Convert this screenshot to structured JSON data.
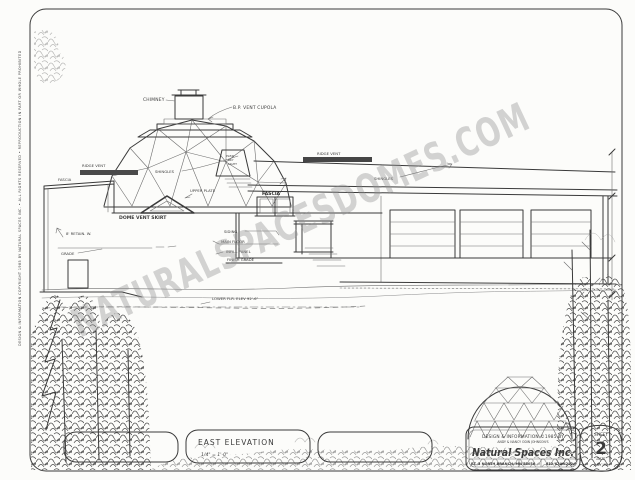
{
  "watermark": {
    "text": "NATURALSPACESDOMES.COM"
  },
  "edge_note": {
    "text": "DESIGN & INFORMATION COPYRIGHT 1985 BY NATURAL SPACES INC. • ALL RIGHTS RESERVED • REPRODUCTION IN PART OR WHOLE PROHIBITED"
  },
  "drawing": {
    "labels": {
      "chimney": "CHIMNEY",
      "vent_cupola": "B.P. VENT CUPOLA",
      "ridge_vent_left": "RIDGE VENT",
      "fascia_left": "FASCIA",
      "shingles_dome": "SHINGLES",
      "upper_plate": "UPPER PLATE",
      "dome_vent_skirt": "DOME VENT SKIRT",
      "retaining_wall": "8' RETAIN. W.",
      "grade": "GRADE",
      "siding": "SIDING",
      "main_floor": "MAIN FLOOR",
      "infill_panel": "INFILL PANEL",
      "finish_grade": "FINISH GRADE",
      "lower_floor_elev": "LOWER FLR. ELEV 92'-6\"",
      "ridge_vent_right": "RIDGE VENT",
      "shingles_right": "SHINGLES",
      "fascia_right": "FASCIA"
    },
    "skylight": {
      "l1": "PLEXI",
      "l2": "SKY",
      "l3": "LIGHT"
    }
  },
  "title_box": {
    "title": "EAST ELEVATION",
    "scale": "1/4\" = 1'-0\""
  },
  "title_block": {
    "line1": "DESIGN & INFORMATION ©1985 BY",
    "line2": "ANDY & NANCY ODIN JOHNSON'S",
    "company": "Natural Spaces Inc.",
    "addr_left": "RT. 3 NORTH BRANCH, MN",
    "addr_mid": "55056",
    "addr_right": "612/674-4292",
    "sheet_label": "SHEET",
    "sheet_number": "2",
    "date_label": "DATE",
    "date_value": "JULY '85"
  }
}
